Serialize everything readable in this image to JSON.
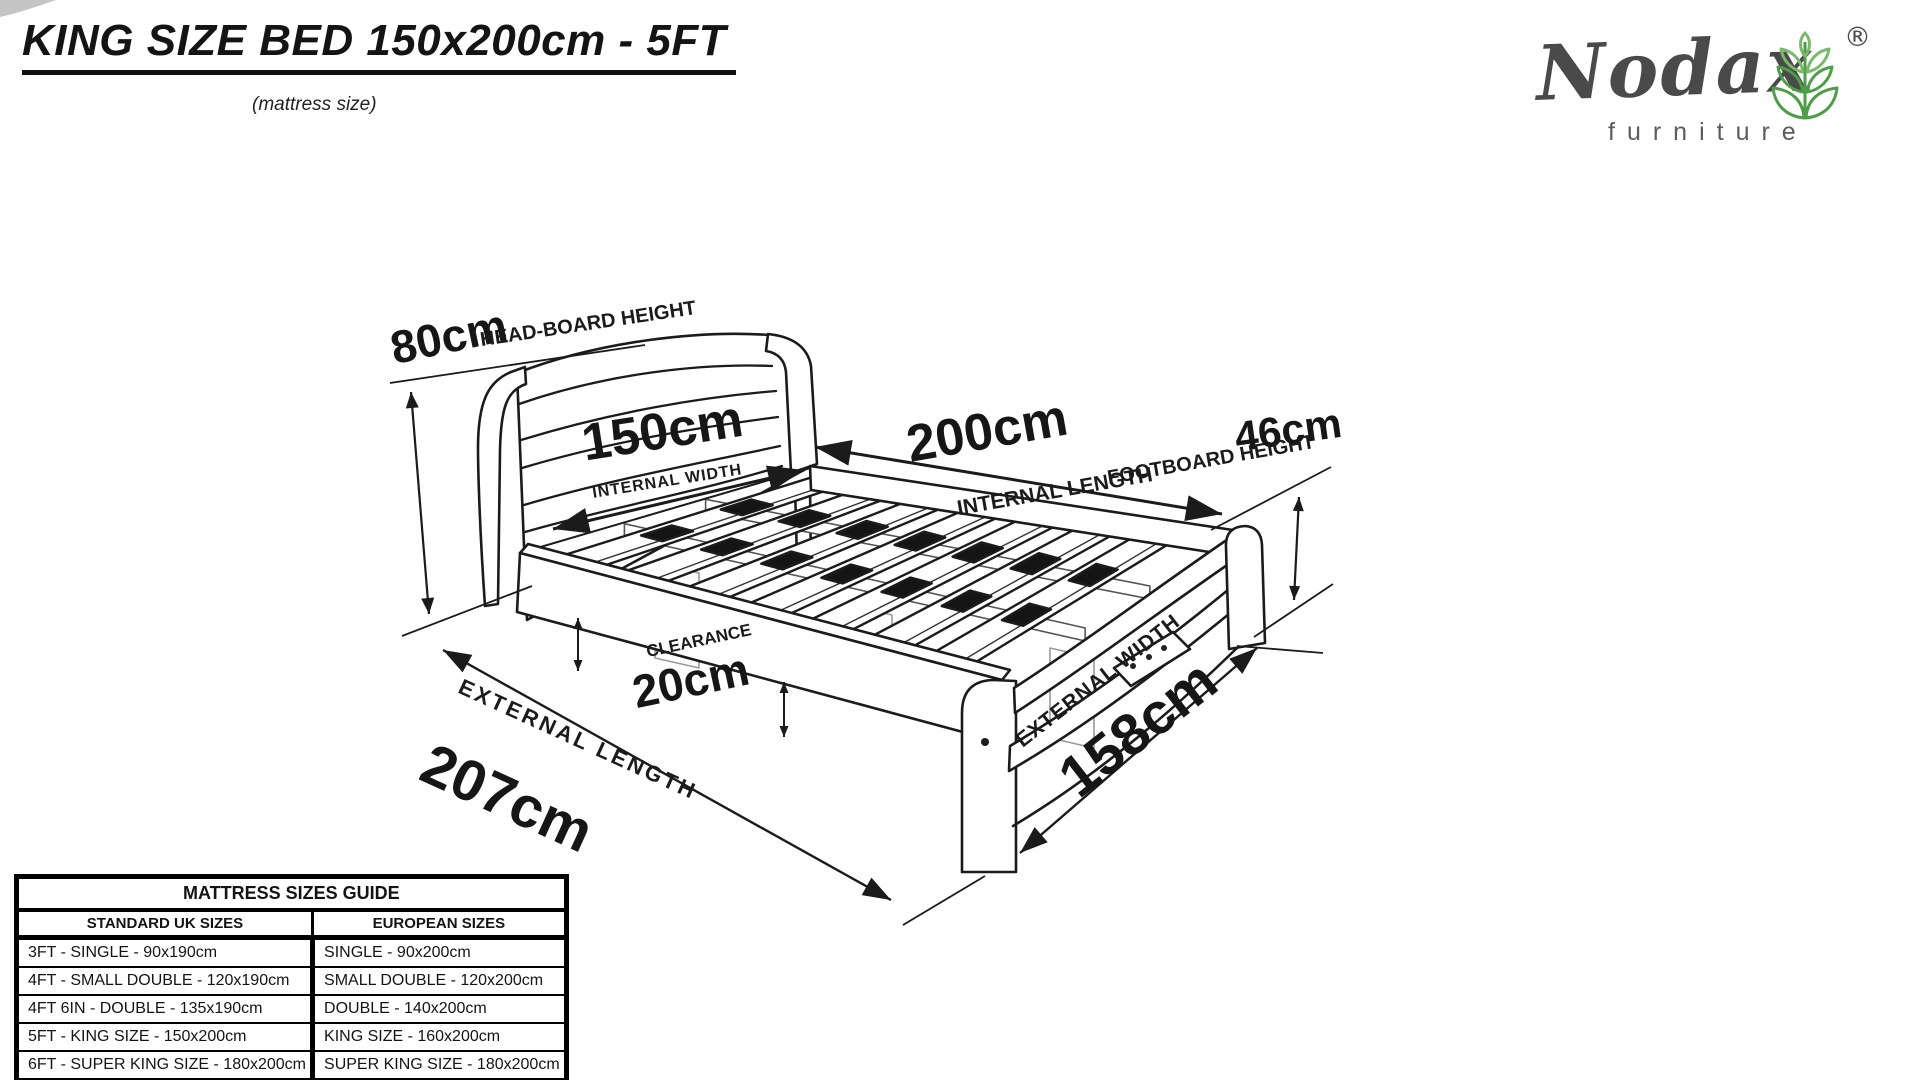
{
  "page": {
    "title": "KING SIZE BED 150x200cm - 5FT",
    "subtitle": "(mattress size)"
  },
  "logo": {
    "brand": "Nodax",
    "tagline": "furniture",
    "registered_mark": "®",
    "icon": "wheat-plant-icon",
    "brand_color": "#4a4a4a",
    "leaf_green": "#4e9d48",
    "leaf_green_light": "#7ab96b"
  },
  "colors": {
    "line": "#1b1b1b"
  },
  "diagram": {
    "headboard_height_value": "80cm",
    "headboard_height_label": "HEAD-BOARD HEIGHT",
    "internal_width_value": "150cm",
    "internal_width_label": "INTERNAL WIDTH",
    "internal_length_value": "200cm",
    "internal_length_label": "INTERNAL LENGTH",
    "footboard_height_value": "46cm",
    "footboard_height_label": "FOOTBOARD HEIGHT",
    "clearance_value": "20cm",
    "clearance_label": "CLEARANCE",
    "external_length_value": "207cm",
    "external_length_label": "EXTERNAL LENGTH",
    "external_width_value": "158cm",
    "external_width_label": "EXTERNAL WIDTH"
  },
  "table": {
    "title": "MATTRESS SIZES GUIDE",
    "columns": [
      "STANDARD UK SIZES",
      "EUROPEAN SIZES"
    ],
    "rows": [
      [
        "3FT - SINGLE  - 90x190cm",
        "SINGLE  - 90x200cm"
      ],
      [
        "4FT - SMALL DOUBLE  - 120x190cm",
        "SMALL DOUBLE - 120x200cm"
      ],
      [
        "4FT 6IN - DOUBLE - 135x190cm",
        "DOUBLE  - 140x200cm"
      ],
      [
        "5FT - KING SIZE  - 150x200cm",
        "KING SIZE  - 160x200cm"
      ],
      [
        "6FT - SUPER KING SIZE  - 180x200cm",
        "SUPER KING SIZE - 180x200cm"
      ]
    ]
  }
}
